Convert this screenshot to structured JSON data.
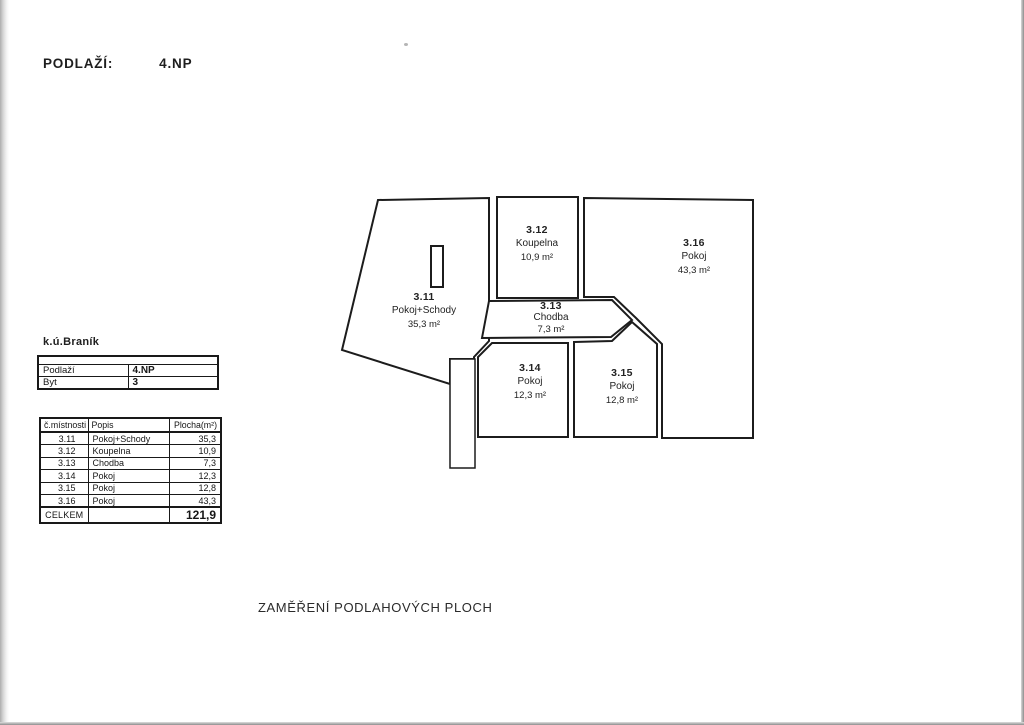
{
  "page": {
    "floor_label": "PODLAŽÍ:",
    "floor_value": "4.NP",
    "cadastral": "k.ú.Braník",
    "caption": "ZAMĚŘENÍ PODLAHOVÝCH PLOCH"
  },
  "info_table": {
    "rows": [
      {
        "label": "Podlaží",
        "value": "4.NP"
      },
      {
        "label": "Byt",
        "value": "3"
      }
    ]
  },
  "rooms_table": {
    "headers": [
      "č.místnosti",
      "Popis",
      "Plocha(m²)"
    ],
    "rows": [
      [
        "3.11",
        "Pokoj+Schody",
        "35,3"
      ],
      [
        "3.12",
        "Koupelna",
        "10,9"
      ],
      [
        "3.13",
        "Chodba",
        "7,3"
      ],
      [
        "3.14",
        "Pokoj",
        "12,3"
      ],
      [
        "3.15",
        "Pokoj",
        "12,8"
      ],
      [
        "3.16",
        "Pokoj",
        "43,3"
      ]
    ],
    "total_label": "CELKEM",
    "total_value": "121,9"
  },
  "floorplan": {
    "rooms": [
      {
        "id": "3.11",
        "name": "Pokoj+Schody",
        "area": "35,3 m²"
      },
      {
        "id": "3.12",
        "name": "Koupelna",
        "area": "10,9 m²"
      },
      {
        "id": "3.13",
        "name": "Chodba",
        "area": "7,3 m²"
      },
      {
        "id": "3.14",
        "name": "Pokoj",
        "area": "12,3 m²"
      },
      {
        "id": "3.15",
        "name": "Pokoj",
        "area": "12,8 m²"
      },
      {
        "id": "3.16",
        "name": "Pokoj",
        "area": "43,3 m²"
      }
    ]
  },
  "colors": {
    "line": "#1c1c1c",
    "paper": "#ffffff"
  }
}
